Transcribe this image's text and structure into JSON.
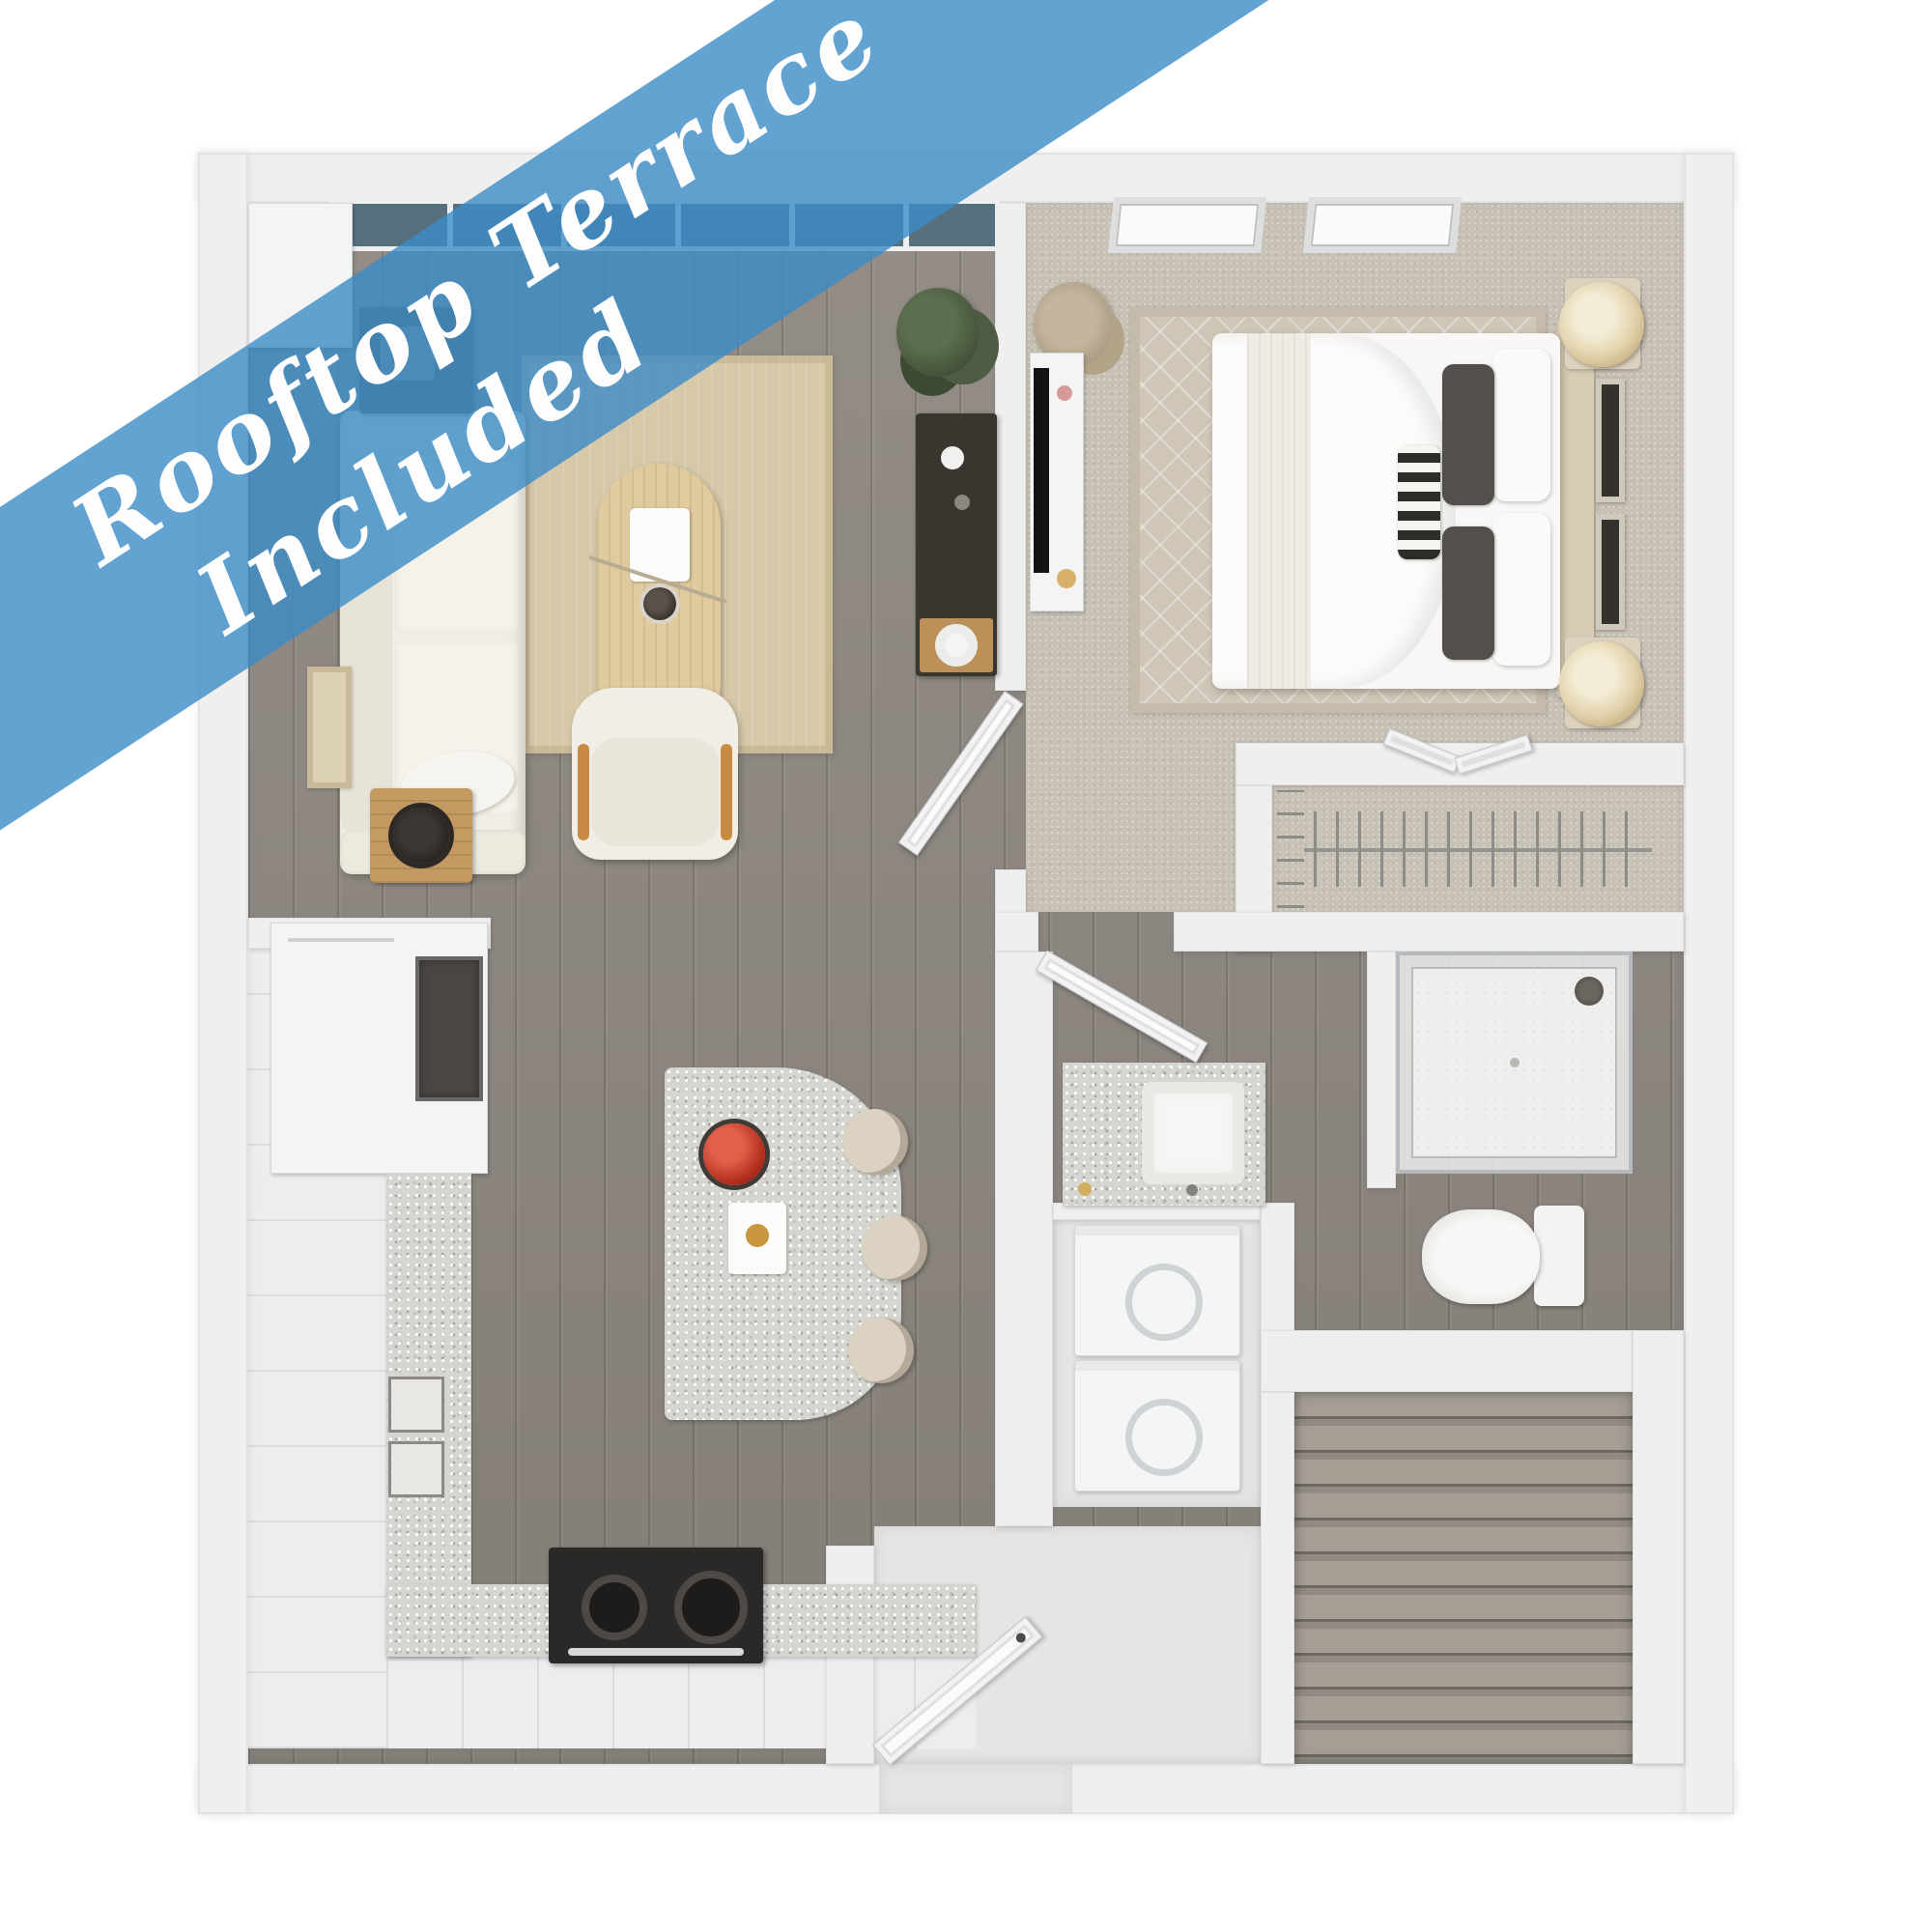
{
  "banner": {
    "line1": "Rooftop Terrace",
    "line2": "Included"
  },
  "floor_plan": {
    "title": "One-bedroom apartment 3D floor plan, top-down view",
    "rooms": [
      {
        "name": "Living room"
      },
      {
        "name": "Kitchen"
      },
      {
        "name": "Bedroom"
      },
      {
        "name": "Walk-in closet"
      },
      {
        "name": "Bathroom"
      },
      {
        "name": "Laundry closet"
      },
      {
        "name": "Entry foyer"
      },
      {
        "name": "Staircase"
      }
    ],
    "furniture": [
      "sofa",
      "coffee table",
      "area rug",
      "accent chair",
      "side table",
      "bar cabinet",
      "kitchen island with stools",
      "range",
      "wall oven",
      "refrigerator cabinet",
      "queen bed",
      "nightstands with lamps",
      "dresser with tv",
      "bedroom rug",
      "hanging clothes rod",
      "glass shower",
      "toilet",
      "vanity sink",
      "stacked washer and dryer",
      "entry door",
      "windows",
      "plants"
    ]
  },
  "colors": {
    "page_bg": "#ffffff",
    "banner_fill": "rgba(59,140,199,0.80)",
    "banner_text": "#fdfdfd",
    "wall": "#f0efef",
    "wood": "#8e8781",
    "carpet": "#c8c1b5",
    "rug": "#d6c8a9",
    "granite": "#d6d6d1",
    "tile": "#e6e5e3"
  }
}
